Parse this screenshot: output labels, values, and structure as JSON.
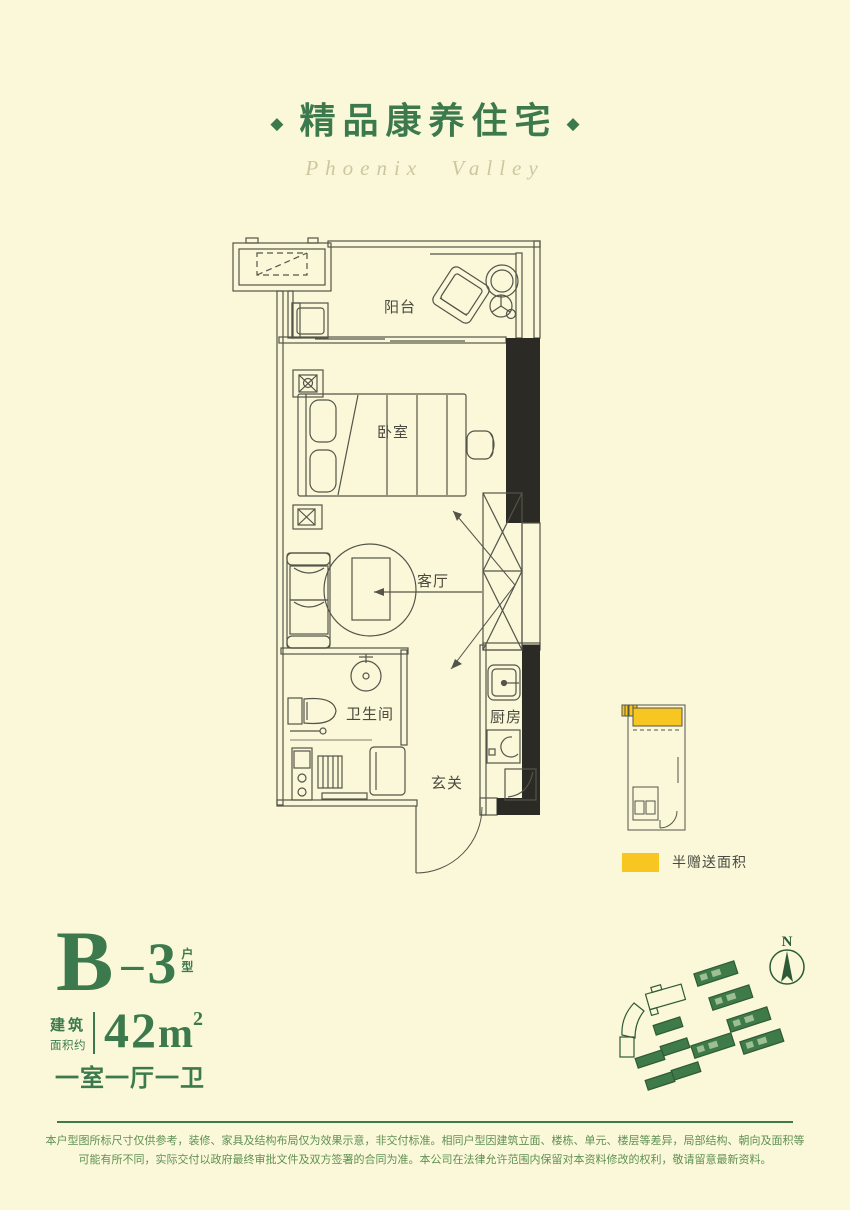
{
  "colors": {
    "background": "#FAF8D9",
    "accent_green": "#3C7A4D",
    "plan_line": "#54544A",
    "wall_dark": "#2B2A24",
    "highlight_yellow": "#F7C621",
    "disclaimer_green": "#5F9054"
  },
  "header": {
    "left_diamond": "◆",
    "right_diamond": "◆",
    "title": "精品康养住宅",
    "subtitle": "Phoenix Valley"
  },
  "floorplan": {
    "rooms": {
      "balcony": "阳台",
      "bedroom": "卧室",
      "living_room": "客厅",
      "bathroom": "卫生间",
      "kitchen": "厨房",
      "entry": "玄关"
    }
  },
  "mini_map": {
    "legend_label": "半赠送面积",
    "highlight_color": "#F7C621"
  },
  "unit_info": {
    "code_letter": "B",
    "code_dash": "–",
    "code_number": "3",
    "code_suffix_top": "户",
    "code_suffix_bottom": "型",
    "area_label_top": "建筑",
    "area_label_bottom": "面积约",
    "area_value": "42",
    "area_unit": "m",
    "area_exponent": "2",
    "layout": "一室一厅一卫"
  },
  "site_plan": {
    "compass_label": "N"
  },
  "footer": {
    "disclaimer_line1": "本户型图所标尺寸仅供参考，装修、家具及结构布局仅为效果示意，非交付标准。相同户型因建筑立面、楼栋、单元、楼层等差异，局部结构、朝向及面积等",
    "disclaimer_line2": "可能有所不同，实际交付以政府最终审批文件及双方签署的合同为准。本公司在法律允许范围内保留对本资料修改的权利，敬请留意最新资料。"
  }
}
